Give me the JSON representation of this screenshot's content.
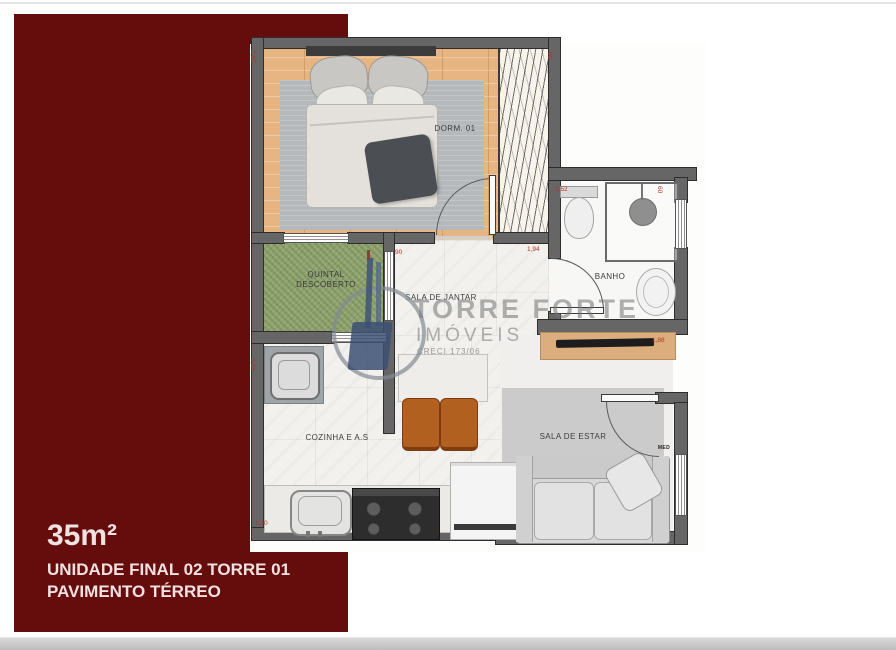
{
  "colors": {
    "panel_maroon": "#650d0d",
    "wall_grey": "#666666",
    "wood_floor": "#e6b582",
    "grass_green": "#8fa370",
    "dimension_red": "#b23228",
    "watermark_grey": "#8f8f8f",
    "bottom_strip": "#cbcbcb"
  },
  "branding_panel": {
    "area": "35m²",
    "unit_line": "UNIDADE FINAL 02 TORRE 01",
    "floor_line": "PAVIMENTO TÉRREO"
  },
  "watermark": {
    "name": "TORRE FORTE",
    "subtitle": "IMÓVEIS",
    "creci": "CRECI 173/06"
  },
  "rooms": {
    "bedroom": "DORM. 01",
    "yard_line1": "QUINTAL",
    "yard_line2": "DESCOBERTO",
    "dining": "SALA DE JANTAR",
    "bath": "BANHO",
    "kitchen": "COZINHA E A.S",
    "living": "SALA DE ESTAR",
    "entry_marker": "MED"
  },
  "dimensions": [
    {
      "text": "2,62",
      "x": 256,
      "y": 50,
      "rot": 90
    },
    {
      "text": "60",
      "x": 553,
      "y": 52,
      "rot": 90
    },
    {
      "text": "1,52",
      "x": 555,
      "y": 186,
      "rot": 0
    },
    {
      "text": "60",
      "x": 663,
      "y": 186,
      "rot": 90
    },
    {
      "text": "1,94",
      "x": 527,
      "y": 246,
      "rot": 0
    },
    {
      "text": "90",
      "x": 395,
      "y": 249,
      "rot": 0
    },
    {
      "text": "3,13",
      "x": 256,
      "y": 358,
      "rot": 90
    },
    {
      "text": "1,88",
      "x": 652,
      "y": 337,
      "rot": 0
    },
    {
      "text": "1,30",
      "x": 255,
      "y": 520,
      "rot": 0
    }
  ]
}
